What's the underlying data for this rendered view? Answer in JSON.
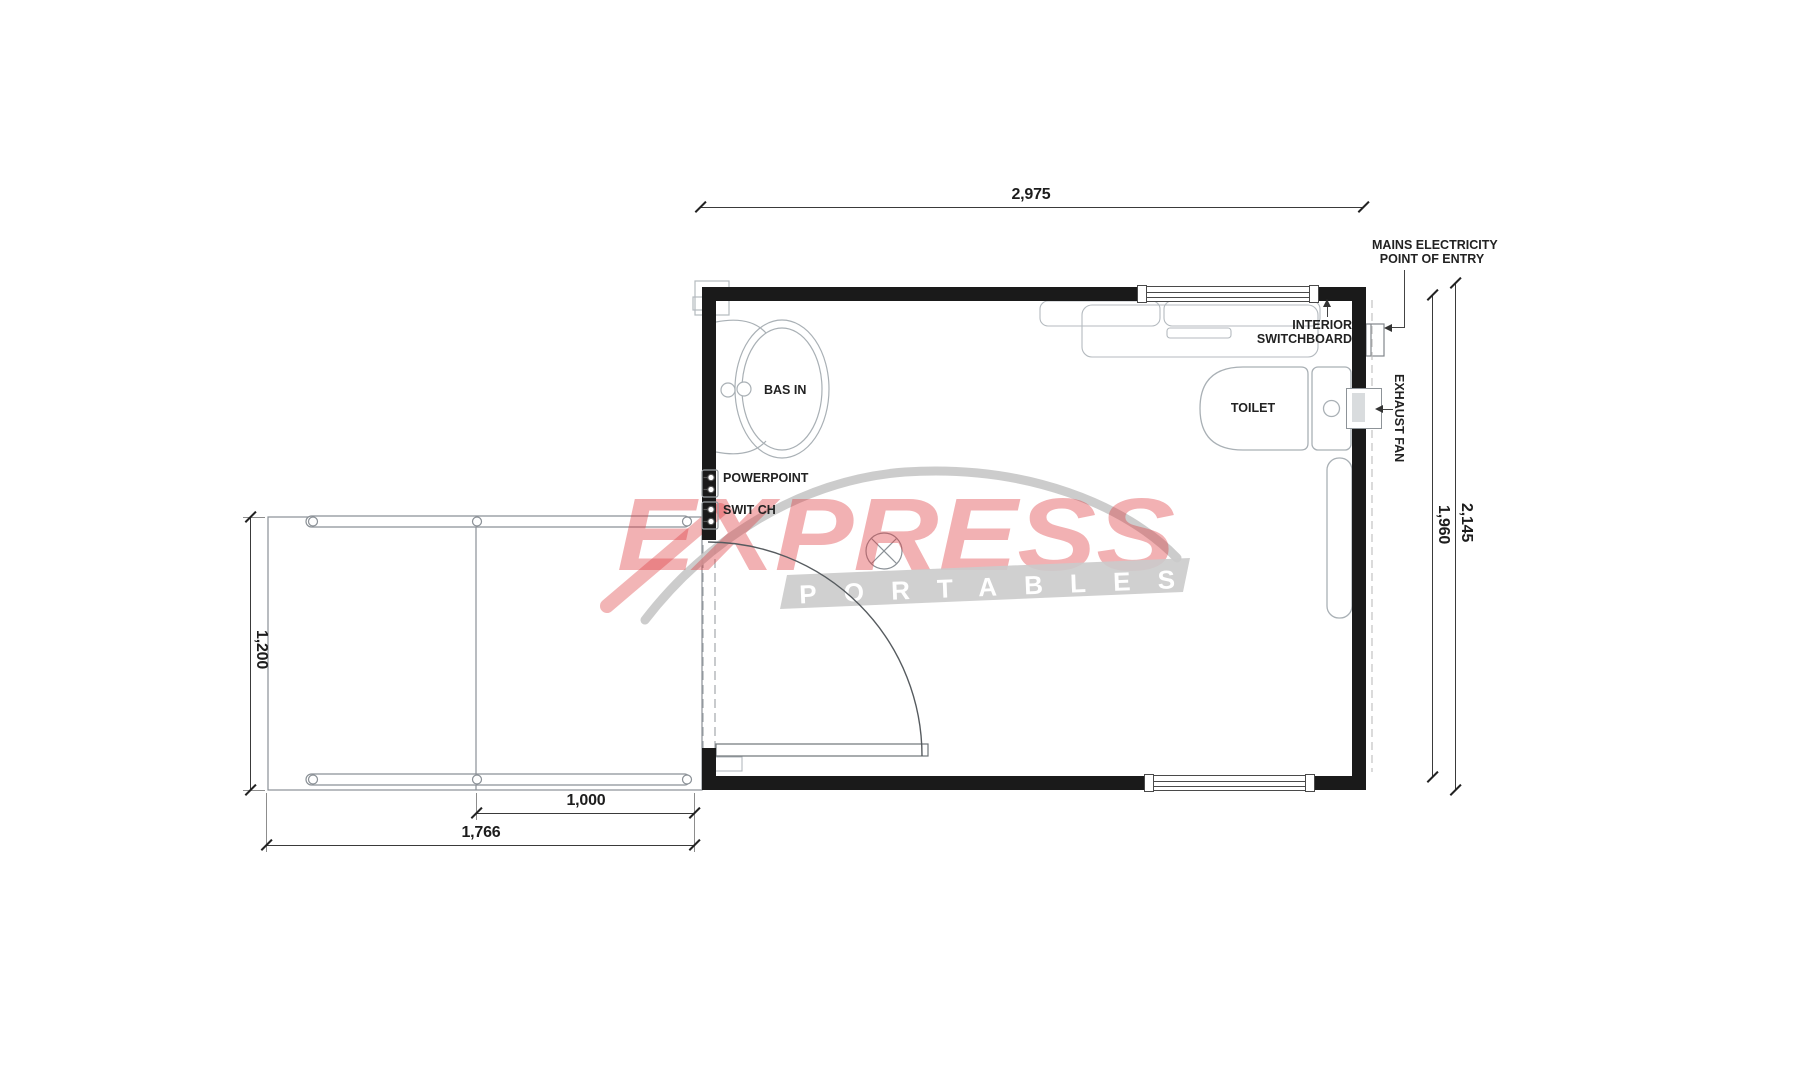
{
  "title": "Portable toilet floor plan",
  "dimensions": {
    "overall_width": "2,975",
    "overall_height": "2,145",
    "internal_height": "1,960",
    "ramp_depth": "1,200",
    "landing_width": "1,000",
    "ramp_length": "1,766"
  },
  "fixtures": {
    "basin": "BAS IN",
    "toilet": "TOILET",
    "powerpoint": "POWERPOINT",
    "switch": "SWIT CH"
  },
  "annotations": {
    "mains_line1": "MAINS ELECTRICITY",
    "mains_line2": "POINT OF ENTRY",
    "switchboard_line1": "INTERIOR",
    "switchboard_line2": "SWITCHBOARD",
    "exhaust_fan": "EXHAUST FAN"
  },
  "watermark": {
    "brand": "EXPRESS",
    "sub": "PORTABLES"
  },
  "colors": {
    "wall": "#1a1a1a",
    "fixture_line": "#a9b0b5",
    "ramp_line": "#8a9096",
    "dim_line": "#3a3a3a",
    "brand_red": "#de3c40",
    "brand_gray": "#c9c9c9"
  }
}
